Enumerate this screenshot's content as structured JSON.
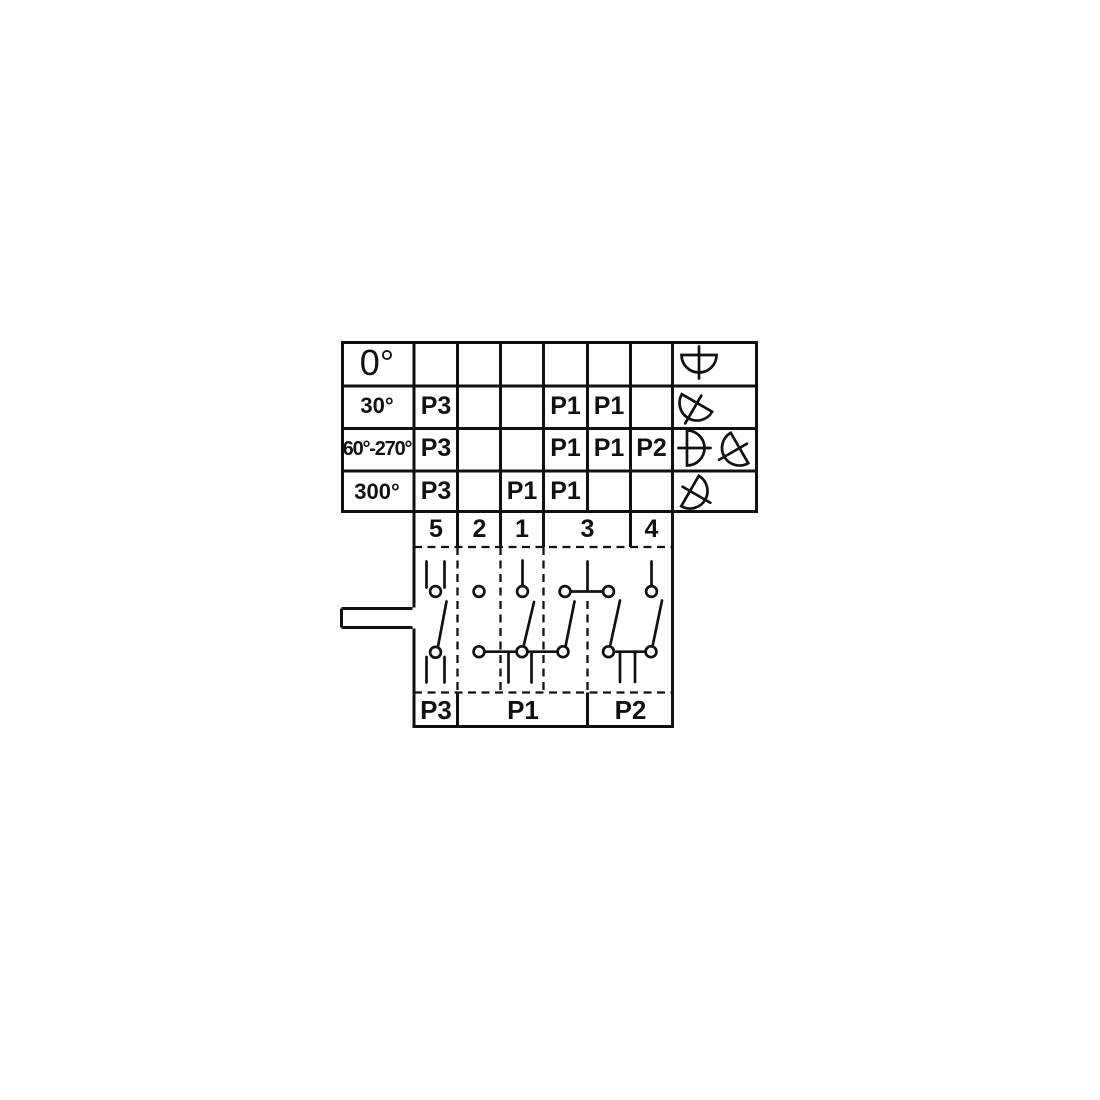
{
  "colors": {
    "line": "#111111",
    "background": "#ffffff"
  },
  "positions_table": {
    "rows": [
      {
        "angle": "0°",
        "cells": [
          "",
          "",
          "",
          "",
          "",
          ""
        ],
        "icons": [
          "knob-0deg"
        ]
      },
      {
        "angle": "30°",
        "cells": [
          "P3",
          "",
          "",
          "P1",
          "P1",
          ""
        ],
        "icons": [
          "knob-30deg"
        ]
      },
      {
        "angle": "60°-270°",
        "cells": [
          "P3",
          "",
          "",
          "P1",
          "P1",
          "P2"
        ],
        "icons": [
          "knob-270deg",
          "knob-60deg"
        ]
      },
      {
        "angle": "300°",
        "cells": [
          "P3",
          "",
          "P1",
          "P1",
          "",
          ""
        ],
        "icons": [
          "knob-300deg"
        ]
      }
    ]
  },
  "contact_row": {
    "numbers": [
      "5",
      "2",
      "1",
      "3",
      "4"
    ]
  },
  "pole_row": {
    "labels": [
      "P3",
      "P1",
      "P2"
    ]
  }
}
